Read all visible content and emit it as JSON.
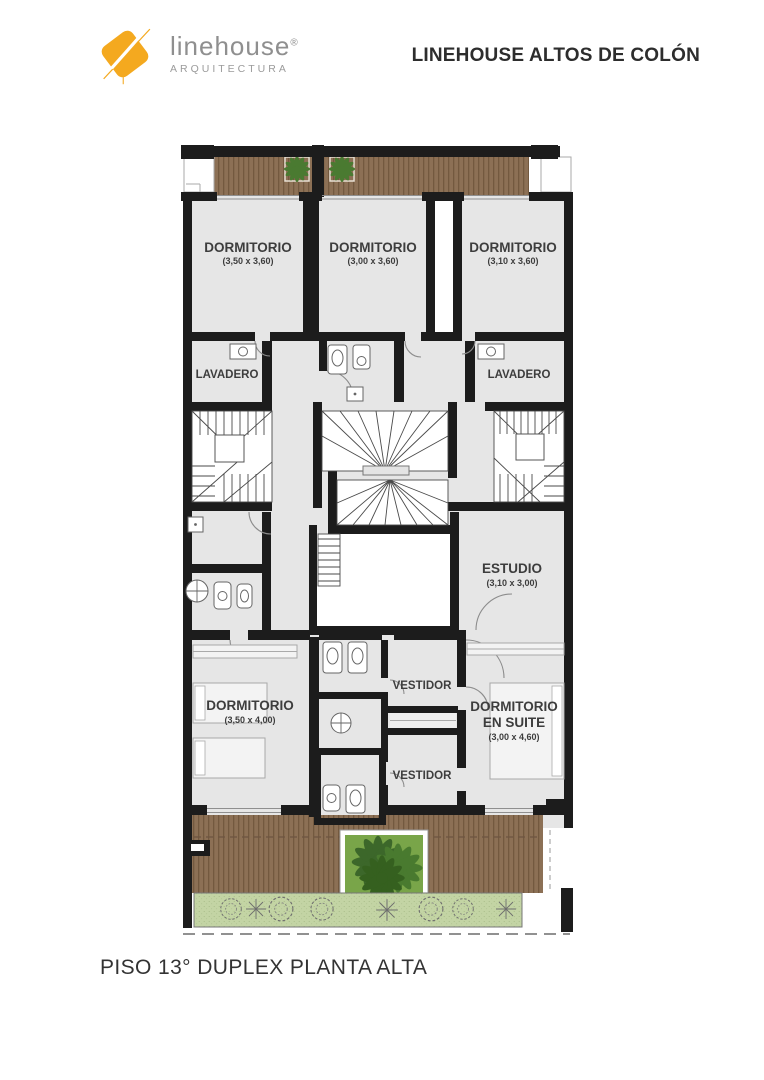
{
  "header": {
    "logo": {
      "brand": "linehouse",
      "registered": "®",
      "tagline": "ARQUITECTURA"
    },
    "project_title": "LINEHOUSE ALTOS DE COLÓN"
  },
  "plan": {
    "rooms": [
      {
        "id": "dormitorio-1",
        "label": "DORMITORIO",
        "dims": "(3,50 x 3,60)"
      },
      {
        "id": "dormitorio-2",
        "label": "DORMITORIO",
        "dims": "(3,00 x 3,60)"
      },
      {
        "id": "dormitorio-3",
        "label": "DORMITORIO",
        "dims": "(3,10 x 3,60)"
      },
      {
        "id": "lavadero-left",
        "label": "LAVADERO"
      },
      {
        "id": "lavadero-right",
        "label": "LAVADERO"
      },
      {
        "id": "estudio",
        "label": "ESTUDIO",
        "dims": "(3,10 x 3,00)"
      },
      {
        "id": "dormitorio-4",
        "label": "DORMITORIO",
        "dims": "(3,50 x 4,00)"
      },
      {
        "id": "vestidor-1",
        "label": "VESTIDOR"
      },
      {
        "id": "dormitorio-suite",
        "label": "DORMITORIO",
        "label2": "EN SUITE",
        "dims": "(3,00 x 4,60)"
      },
      {
        "id": "vestidor-2",
        "label": "VESTIDOR"
      }
    ]
  },
  "footer": {
    "plan_title": "PISO 13° DUPLEX PLANTA ALTA"
  },
  "colors": {
    "wall": "#1c1c1c",
    "room": "#e6e6e6",
    "wood": "#8c7055",
    "wood_line": "#73593f",
    "deck_dash": "#6d5440",
    "plant": "#4a7a31",
    "planter_green": "#79a549",
    "grass": "#c3d4a4",
    "text": "#3d3d3d",
    "title": "#2d2d2d",
    "logo_yellow": "#f4a91f",
    "brand_gray": "#8f8f8f"
  }
}
